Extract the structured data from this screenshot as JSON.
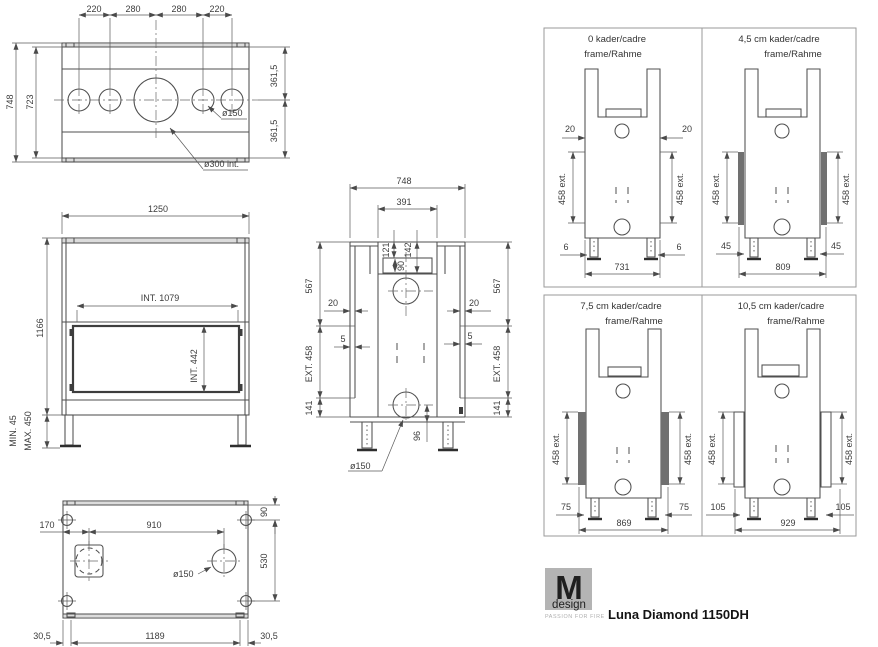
{
  "product": {
    "name": "Luna Diamond 1150DH"
  },
  "logo": {
    "letter": "M",
    "brand": "design",
    "tagline": "PASSION FOR FIRE"
  },
  "top_view": {
    "top_dims": [
      "220",
      "280",
      "280",
      "220"
    ],
    "overall_depth": "748",
    "inner_depth": "723",
    "right_half_top": "361,5",
    "right_half_bottom": "361,5",
    "hole_small": "ø150",
    "hole_large": "ø300 int."
  },
  "front_view": {
    "overall_width": "1250",
    "overall_height": "1166",
    "inner_width": "INT. 1079",
    "inner_height": "INT. 442",
    "leg_min": "MIN. 45",
    "leg_max": "MAX. 450"
  },
  "bottom_view": {
    "offset_left": "170",
    "hole_spacing": "910",
    "edge_top": "90",
    "bolt_spacing": "530",
    "hole": "ø150",
    "margin_left": "30,5",
    "base_width": "1189",
    "margin_right": "30,5"
  },
  "side_view": {
    "overall_depth": "748",
    "top_opening": "391",
    "dim_121": "121",
    "dim_142": "142",
    "dim_90": "90",
    "height_top_left": "567",
    "height_top_right": "567",
    "wall_left": "20",
    "wall_right": "20",
    "gap_left": "5",
    "gap_right": "5",
    "ext_left": "EXT. 458",
    "ext_right": "EXT. 458",
    "base_left": "141",
    "base_right": "141",
    "flue_offset": "96",
    "hole": "ø150"
  },
  "frames": [
    {
      "title": "0  kader/cadre",
      "subtitle": "frame/Rahme",
      "offset_left": "20",
      "offset_right": "20",
      "ext_left": "458 ext.",
      "ext_right": "458 ext.",
      "foot_left": "6",
      "foot_right": "6",
      "width": "731"
    },
    {
      "title": "4,5 cm  kader/cadre",
      "subtitle": "frame/Rahme",
      "ext_left": "458 ext.",
      "ext_right": "458 ext.",
      "foot_left": "45",
      "foot_right": "45",
      "width": "809"
    },
    {
      "title": "7,5 cm  kader/cadre",
      "subtitle": "frame/Rahme",
      "ext_left": "458 ext.",
      "ext_right": "458 ext.",
      "foot_left": "75",
      "foot_right": "75",
      "width": "869"
    },
    {
      "title": "10,5 cm kader/cadre",
      "subtitle": "frame/Rahme",
      "ext_left": "458 ext.",
      "ext_right": "458 ext.",
      "foot_left": "105",
      "foot_right": "105",
      "width": "929"
    }
  ]
}
